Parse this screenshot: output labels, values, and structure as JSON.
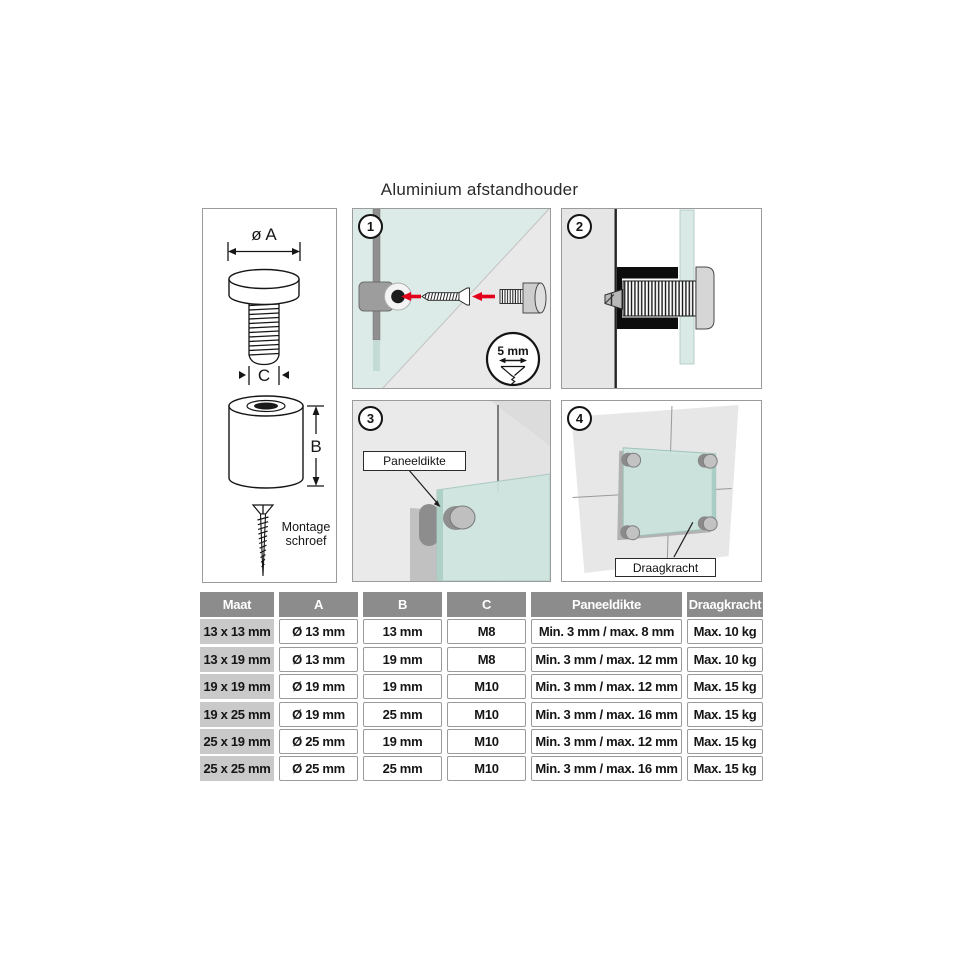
{
  "title": "Aluminium afstandhouder",
  "product": {
    "dim_a": "ø A",
    "dim_b": "B",
    "dim_c": "C",
    "screw_line1": "Montage",
    "screw_line2": "schroef"
  },
  "steps": [
    {
      "number": "1",
      "detail": "5 mm"
    },
    {
      "number": "2"
    },
    {
      "number": "3",
      "callout": "Paneeldikte"
    },
    {
      "number": "4",
      "callout": "Draagkracht"
    }
  ],
  "table": {
    "headers": [
      "Maat",
      "A",
      "B",
      "C",
      "Paneeldikte",
      "Draagkracht"
    ],
    "rows": [
      [
        "13 x 13 mm",
        "Ø 13 mm",
        "13 mm",
        "M8",
        "Min. 3 mm / max. 8 mm",
        "Max. 10 kg"
      ],
      [
        "13 x 19 mm",
        "Ø 13 mm",
        "19 mm",
        "M8",
        "Min. 3 mm / max. 12 mm",
        "Max. 10 kg"
      ],
      [
        "19 x 19 mm",
        "Ø 19 mm",
        "19 mm",
        "M10",
        "Min. 3 mm / max. 12 mm",
        "Max. 15 kg"
      ],
      [
        "19 x 25 mm",
        "Ø 19 mm",
        "25 mm",
        "M10",
        "Min. 3 mm / max. 16 mm",
        "Max. 15 kg"
      ],
      [
        "25 x 19 mm",
        "Ø 25 mm",
        "19 mm",
        "M10",
        "Min. 3 mm / max. 12 mm",
        "Max. 15 kg"
      ],
      [
        "25 x 25 mm",
        "Ø 25 mm",
        "25 mm",
        "M10",
        "Min. 3 mm / max. 16 mm",
        "Max. 15 kg"
      ]
    ]
  },
  "colors": {
    "accent_red": "#e2001a",
    "glass_teal": "#d9e8e4",
    "wall_gray": "#e9e9e9",
    "table_header_gray": "#8c8c8c",
    "size_column_gray": "#c9c9c9",
    "line_black": "#141414"
  }
}
